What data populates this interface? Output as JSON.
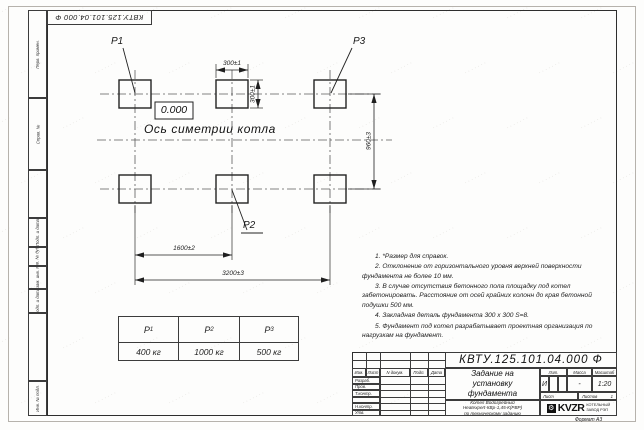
{
  "sheet": {
    "doc_number": "КВТУ.125.101.04.000 Ф",
    "format_label": "Формат А3"
  },
  "margin": {
    "labels": [
      "Перв. примен.",
      "Справ. №",
      "Подп. и дата",
      "Инв. № дубл.",
      "Взам. инв. №",
      "Подп. и дата",
      "Инв. № подл."
    ]
  },
  "drawing": {
    "point_labels": {
      "p1": "P1",
      "p2": "P2",
      "p3": "P3"
    },
    "elevation": "0.000",
    "axis_label": "Ось симетрии котла",
    "dims": {
      "pad_width": "300±1",
      "pad_height": "300±1",
      "row_spacing": "960±3",
      "mid_spacing": "1600±2",
      "total_spacing": "3200±3"
    }
  },
  "notes": [
    "1. *Размер для справок.",
    "2. Отклонение от горизонтального уровня верхней поверхности фундамента не более 10 мм.",
    "3. В случае отсутствия бетонного пола площадку под котел забетонировать. Расстояние от осей крайних колонн до края бетонной подушки 500 мм.",
    "4. Закладная деталь фундамента 300 x 300 S=8.",
    "5. Фундамент под котел разрабатывает проектная организация по нагрузкам на фундамент."
  ],
  "loads_table": {
    "headers": [
      {
        "p": "P",
        "s": "1"
      },
      {
        "p": "P",
        "s": "2"
      },
      {
        "p": "P",
        "s": "3"
      }
    ],
    "values": [
      "400 кг",
      "1000 кг",
      "500 кг"
    ]
  },
  "title_block": {
    "doc_number": "КВТУ.125.101.04.000 Ф",
    "title_lines": [
      "Задание на",
      "установку",
      "фундамента"
    ],
    "product_lines": [
      "Котел Водогрейный",
      "Heatexpert-КВр-1,45-К(РВР)",
      "по техническому заданию"
    ],
    "header_cols": [
      "Изм.",
      "Лист",
      "N докум.",
      "Подп.",
      "Дата"
    ],
    "staff_rows": [
      "Разраб.",
      "Пров.",
      "Т.контр.",
      "",
      "Н.контр.",
      "Утв."
    ],
    "lit_header": "Лит.",
    "mass_header": "Масса",
    "scale_header": "Масштаб",
    "lit_value": "И",
    "mass_value": "-",
    "scale_value": "1:20",
    "sheet_label": "Лист",
    "sheets_label": "Листов",
    "sheets_value": "1",
    "logo_text": "KVZR",
    "logo_caption_lines": [
      "КОТЕЛЬНЫЙ",
      "ЗАВОД РЭП"
    ]
  }
}
